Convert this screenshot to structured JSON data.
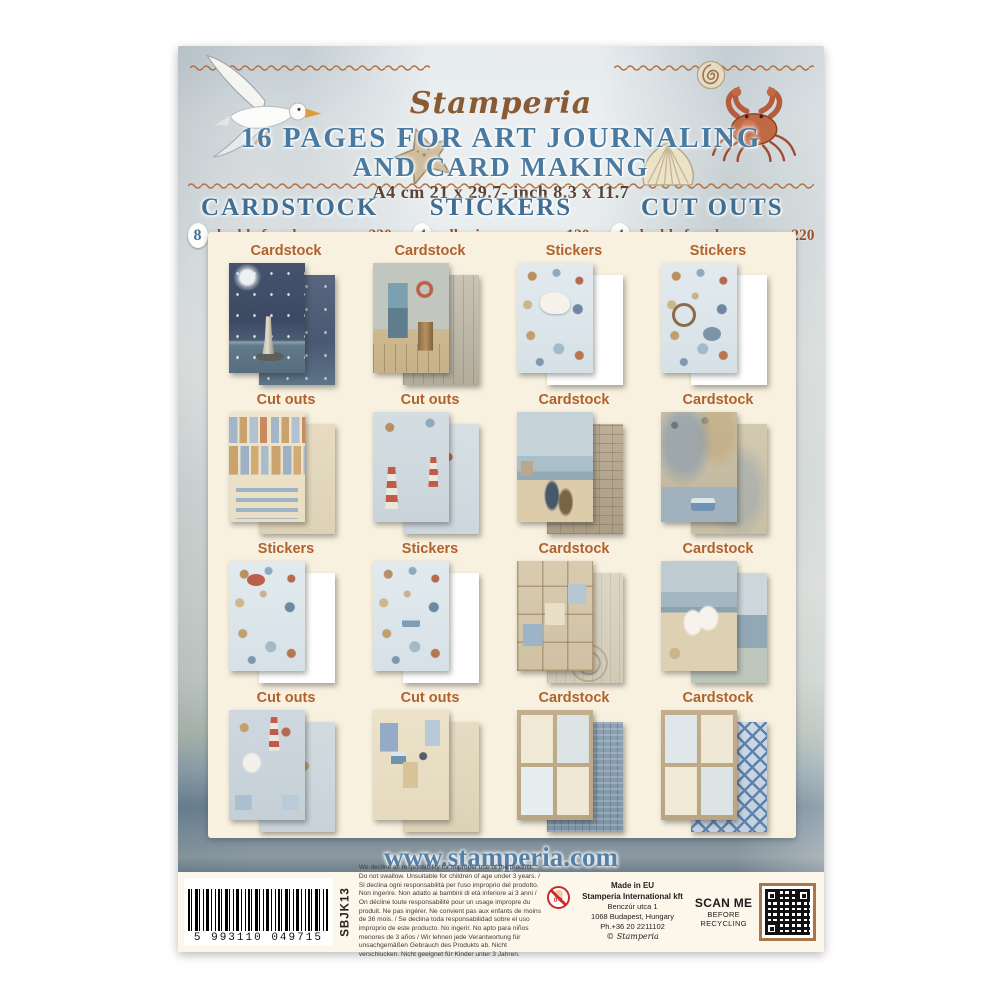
{
  "header": {
    "logo": "Stamperia",
    "title_line1": "16 PAGES FOR ART JOURNALING",
    "title_line2": "AND CARD MAKING",
    "size_line": "A4 cm 21 x 29.7- inch 8.3 x 11.7"
  },
  "product_columns": [
    {
      "name": "CARDSTOCK",
      "count": "8",
      "detail": "double faced pages - gr 220"
    },
    {
      "name": "STICKERS",
      "count": "4",
      "detail": "adhesive pages - gr 120"
    },
    {
      "name": "CUT OUTS",
      "count": "4",
      "detail": "double faced pages - gr 220"
    }
  ],
  "grid": {
    "items": [
      {
        "label": "Cardstock",
        "art": "night-sky-lighthouse"
      },
      {
        "label": "Cardstock",
        "art": "doorway-barrel-lifebuoy"
      },
      {
        "label": "Stickers",
        "art": "sea-creatures-horse"
      },
      {
        "label": "Stickers",
        "art": "ship-wheel-lighthouse-boy"
      },
      {
        "label": "Cut outs",
        "art": "seaside-houses-word-strips"
      },
      {
        "label": "Cut outs",
        "art": "red-lighthouses-boy"
      },
      {
        "label": "Cardstock",
        "art": "beach-boats-stone-wall"
      },
      {
        "label": "Cardstock",
        "art": "vintage-map-camper-van"
      },
      {
        "label": "Stickers",
        "art": "crab-shells-oars-boat"
      },
      {
        "label": "Stickers",
        "art": "camper-van-heart-house"
      },
      {
        "label": "Cardstock",
        "art": "patchwork-frames"
      },
      {
        "label": "Cardstock",
        "art": "horses-on-beach"
      },
      {
        "label": "Cut outs",
        "art": "horses-lighthouse-shells"
      },
      {
        "label": "Cut outs",
        "art": "victorian-houses-anchor"
      },
      {
        "label": "Cardstock",
        "art": "four-tag-panels-denim"
      },
      {
        "label": "Cardstock",
        "art": "four-tag-panels-diamond"
      }
    ]
  },
  "footer": {
    "website": "www.stamperia.com"
  },
  "label_bar": {
    "barcode_digits": "5 993110 049715",
    "sku": "SBJK13",
    "disclaimer": "We decline all responsibility for improper use of the product. Do not swallow. Unsuitable for children of age under 3 years. / Si declina ogni responsabilità per l'uso improprio del prodotto. Non ingerire. Non adatto ai bambini di età inferiore ai 3 anni / On décline toute responsabilité pour un usage impropre du produit. Ne pas ingérer. Ne convient pas aux enfants de moins de 36 mois. / Se declina toda responsabilidad sobre el uso improprio de este producto. No ingerir. No apto para niños menores de 3 años / Wir lehnen jede Verantwortung für unsachgemäßen Gebrauch des Produkts ab. Nicht verschlucken. Nicht geeignet für Kinder unter 3 Jahren.",
    "age_warning": "0-3",
    "made_in": "Made in EU",
    "company": "Stamperia International kft",
    "street": "Benczúr utca 1",
    "city": "1068 Budapest, Hungary",
    "phone": "Ph.+36 20 2211102",
    "copyright": "© Stamperia",
    "scan_line1": "SCAN ME",
    "scan_line2": "BEFORE",
    "scan_line3": "RECYCLING"
  },
  "colors": {
    "accent_blue": "#44719a",
    "accent_rust": "#a65c2e",
    "panel_cream": "#f8f1df",
    "logo_brown": "#8a5a33",
    "wave_line": "#b5713f",
    "qr_border": "#a9764a"
  }
}
